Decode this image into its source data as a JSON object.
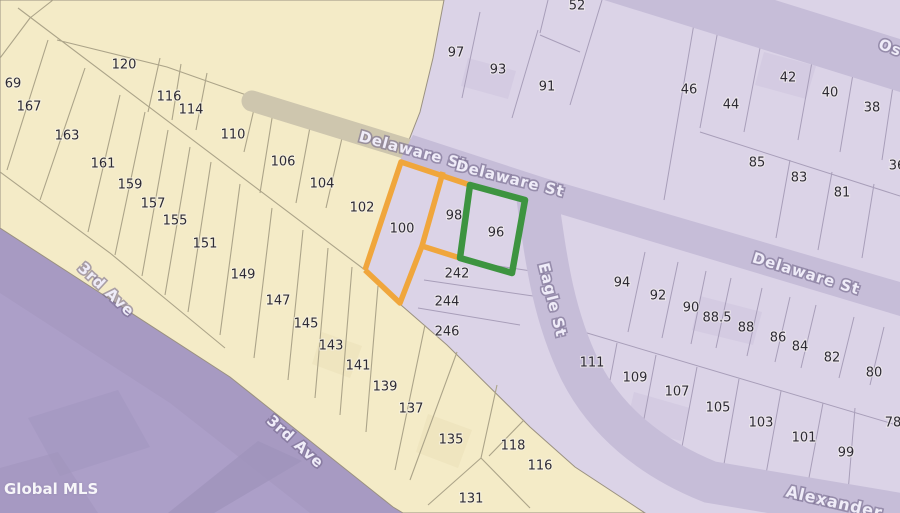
{
  "watermark": "Global MLS",
  "map": {
    "highlight_colors": {
      "orange": "#F0A63C",
      "green": "#3D9440"
    },
    "highlighted_parcels": {
      "orange": [
        "100",
        "98"
      ],
      "green": [
        "96"
      ]
    },
    "street_labels": [
      {
        "text": "Delaware St",
        "x": 413,
        "y": 151,
        "rotate": 15,
        "size": 15
      },
      {
        "text": "Delaware St",
        "x": 510,
        "y": 179,
        "rotate": 14,
        "size": 15
      },
      {
        "text": "Delaware St",
        "x": 806,
        "y": 274,
        "rotate": 17,
        "size": 15
      },
      {
        "text": "Eagle St",
        "x": 552,
        "y": 300,
        "rotate": 76,
        "size": 15
      },
      {
        "text": "3rd Ave",
        "x": 106,
        "y": 290,
        "rotate": 43,
        "size": 15
      },
      {
        "text": "3rd Ave",
        "x": 295,
        "y": 442,
        "rotate": 42,
        "size": 15
      },
      {
        "text": "Os",
        "x": 890,
        "y": 48,
        "rotate": 20,
        "size": 15
      },
      {
        "text": "Alexander",
        "x": 834,
        "y": 503,
        "rotate": 13,
        "size": 16
      }
    ],
    "parcel_labels": [
      {
        "text": "69",
        "x": 13,
        "y": 84
      },
      {
        "text": "167",
        "x": 29,
        "y": 107
      },
      {
        "text": "163",
        "x": 67,
        "y": 136
      },
      {
        "text": "161",
        "x": 103,
        "y": 164
      },
      {
        "text": "159",
        "x": 130,
        "y": 185
      },
      {
        "text": "157",
        "x": 153,
        "y": 204
      },
      {
        "text": "155",
        "x": 175,
        "y": 221
      },
      {
        "text": "151",
        "x": 205,
        "y": 244
      },
      {
        "text": "149",
        "x": 243,
        "y": 275
      },
      {
        "text": "147",
        "x": 278,
        "y": 301
      },
      {
        "text": "145",
        "x": 306,
        "y": 324
      },
      {
        "text": "143",
        "x": 331,
        "y": 346
      },
      {
        "text": "141",
        "x": 358,
        "y": 366
      },
      {
        "text": "139",
        "x": 385,
        "y": 387
      },
      {
        "text": "137",
        "x": 411,
        "y": 409
      },
      {
        "text": "135",
        "x": 451,
        "y": 440
      },
      {
        "text": "131",
        "x": 471,
        "y": 499
      },
      {
        "text": "118",
        "x": 513,
        "y": 446
      },
      {
        "text": "116",
        "x": 540,
        "y": 466
      },
      {
        "text": "120",
        "x": 124,
        "y": 65
      },
      {
        "text": "116",
        "x": 169,
        "y": 97
      },
      {
        "text": "114",
        "x": 191,
        "y": 110
      },
      {
        "text": "110",
        "x": 233,
        "y": 135
      },
      {
        "text": "106",
        "x": 283,
        "y": 162
      },
      {
        "text": "104",
        "x": 322,
        "y": 184
      },
      {
        "text": "102",
        "x": 362,
        "y": 208
      },
      {
        "text": "97",
        "x": 456,
        "y": 53
      },
      {
        "text": "93",
        "x": 498,
        "y": 70
      },
      {
        "text": "91",
        "x": 547,
        "y": 87
      },
      {
        "text": "52",
        "x": 577,
        "y": 6
      },
      {
        "text": "46",
        "x": 689,
        "y": 90
      },
      {
        "text": "44",
        "x": 731,
        "y": 105
      },
      {
        "text": "42",
        "x": 788,
        "y": 78
      },
      {
        "text": "40",
        "x": 830,
        "y": 93
      },
      {
        "text": "38",
        "x": 872,
        "y": 108
      },
      {
        "text": "36",
        "x": 897,
        "y": 166
      },
      {
        "text": "85",
        "x": 757,
        "y": 163
      },
      {
        "text": "83",
        "x": 799,
        "y": 178
      },
      {
        "text": "81",
        "x": 842,
        "y": 193
      },
      {
        "text": "100",
        "x": 402,
        "y": 229
      },
      {
        "text": "98",
        "x": 454,
        "y": 216
      },
      {
        "text": "96",
        "x": 496,
        "y": 233
      },
      {
        "text": "242",
        "x": 457,
        "y": 274
      },
      {
        "text": "244",
        "x": 447,
        "y": 302
      },
      {
        "text": "246",
        "x": 447,
        "y": 332
      },
      {
        "text": "94",
        "x": 622,
        "y": 283
      },
      {
        "text": "92",
        "x": 658,
        "y": 296
      },
      {
        "text": "90",
        "x": 691,
        "y": 308
      },
      {
        "text": "88.5",
        "x": 717,
        "y": 318
      },
      {
        "text": "88",
        "x": 746,
        "y": 328
      },
      {
        "text": "86",
        "x": 778,
        "y": 338
      },
      {
        "text": "84",
        "x": 800,
        "y": 347
      },
      {
        "text": "82",
        "x": 832,
        "y": 358
      },
      {
        "text": "80",
        "x": 874,
        "y": 373
      },
      {
        "text": "111",
        "x": 592,
        "y": 363
      },
      {
        "text": "109",
        "x": 635,
        "y": 378
      },
      {
        "text": "107",
        "x": 677,
        "y": 392
      },
      {
        "text": "105",
        "x": 718,
        "y": 408
      },
      {
        "text": "103",
        "x": 761,
        "y": 423
      },
      {
        "text": "101",
        "x": 804,
        "y": 438
      },
      {
        "text": "99",
        "x": 846,
        "y": 453
      },
      {
        "text": "78",
        "x": 893,
        "y": 423
      }
    ]
  }
}
